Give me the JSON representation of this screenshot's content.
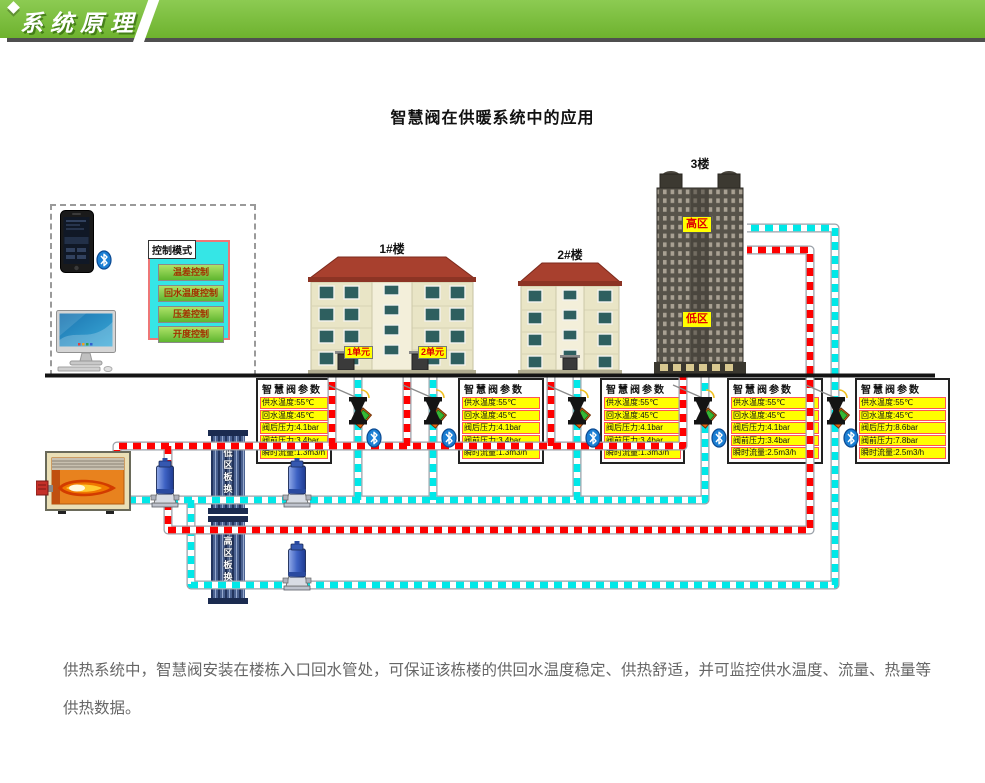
{
  "header": {
    "banner_title": "系统原理"
  },
  "page": {
    "title": "智慧阀在供暖系统中的应用"
  },
  "control_panel": {
    "title": "控制模式",
    "buttons": [
      "温差控制",
      "回水温度控制",
      "压差控制",
      "开度控制"
    ]
  },
  "buildings": [
    {
      "label": "1#楼",
      "units": [
        "1单元",
        "2单元"
      ]
    },
    {
      "label": "2#楼"
    },
    {
      "label": "3楼",
      "zones": [
        "高区",
        "低区"
      ]
    }
  ],
  "heat_exchangers": [
    {
      "label": "低区板换"
    },
    {
      "label": "高区板换"
    }
  ],
  "valve_boxes": [
    {
      "title": "智慧阀参数",
      "rows": [
        "供水温度:55℃",
        "回水温度:45℃",
        "阀后压力:4.1bar",
        "阀前压力:3.4bar",
        "瞬时流量:1.3m3/h"
      ]
    },
    {
      "title": "智慧阀参数",
      "rows": [
        "供水温度:55℃",
        "回水温度:45℃",
        "阀后压力:4.1bar",
        "阀前压力:3.4bar",
        "瞬时流量:1.3m3/h"
      ]
    },
    {
      "title": "智慧阀参数",
      "rows": [
        "供水温度:55℃",
        "回水温度:45℃",
        "阀后压力:4.1bar",
        "阀前压力:3.4bar",
        "瞬时流量:1.3m3/h"
      ]
    },
    {
      "title": "智慧阀参数",
      "rows": [
        "供水温度:55℃",
        "回水温度:45℃",
        "阀后压力:4.1bar",
        "阀前压力:3.4bar",
        "瞬时流量:2.5m3/h"
      ]
    },
    {
      "title": "智慧阀参数",
      "rows": [
        "供水温度:55℃",
        "回水温度:45℃",
        "阀后压力:8.6bar",
        "阀前压力:7.8bar",
        "瞬时流量:2.5m3/h"
      ]
    }
  ],
  "footer": {
    "text": "供热系统中，智慧阀安装在楼栋入口回水管处，可保证该栋楼的供回水温度稳定、供热舒适，并可监控供水温度、流量、热量等供热数据。"
  },
  "colors": {
    "banner_green": "#79BD3B",
    "supply_pipe_red": "#FF0000",
    "return_pipe_cyan": "#00E8E8",
    "highlight_yellow": "#FFFF00",
    "panel_cyan": "#35E6E6"
  },
  "icons": {
    "bluetooth": "bluetooth-icon"
  }
}
